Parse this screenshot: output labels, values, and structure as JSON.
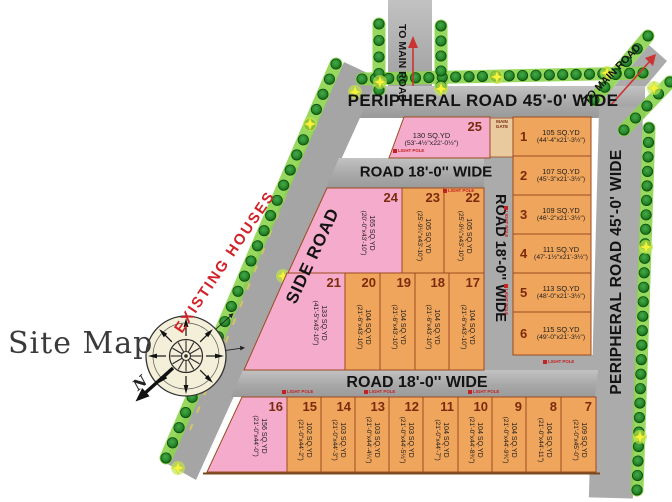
{
  "title": "Site Map",
  "annotations": {
    "existing_houses": "EXISTING HOUSES",
    "north": "N"
  },
  "roads": {
    "peripheral_top": "PERIPHERAL ROAD 45'-0' WIDE",
    "peripheral_right": "PERIPHERAL ROAD 45'-0' WIDE",
    "side": "SIDE ROAD",
    "inner_top": "ROAD 18'-0'' WIDE",
    "inner_vertical": "ROAD 18'-0'' WIDE",
    "inner_bottom": "ROAD 18'-0'' WIDE",
    "to_main_left": "TO MAIN ROAD",
    "to_main_right": "TO MAIN ROAD",
    "main_gate": "MAIN GATE",
    "light_pole": "LIGHT POLE"
  },
  "colors": {
    "plot_orange": "#F0A55C",
    "plot_pink": "#F5ABCB",
    "plot_border": "#9C4A1F",
    "road_gray": "#AFAFAF",
    "strip_green": "#8CD44E",
    "tree_dark": "#166916",
    "tree_mid": "#2E9232",
    "star_yellow": "#F4F43C",
    "number_brown": "#7A2B0C",
    "accent_red": "#D2232A"
  },
  "plots": [
    {
      "num": "1",
      "area": "105 SQ.YD",
      "dims": "(44'-4\"x21'-3½\")",
      "color": "orange"
    },
    {
      "num": "2",
      "area": "107 SQ.YD",
      "dims": "(45'-3\"x21'-3½\")",
      "color": "orange"
    },
    {
      "num": "3",
      "area": "109 SQ.YD",
      "dims": "(46'-2\"x21'-3½\")",
      "color": "orange"
    },
    {
      "num": "4",
      "area": "111 SQ.YD",
      "dims": "(47'-1½\"x21'-3½\")",
      "color": "orange"
    },
    {
      "num": "5",
      "area": "113 SQ.YD",
      "dims": "(48'-0\"x21'-3½\")",
      "color": "orange"
    },
    {
      "num": "6",
      "area": "115 SQ.YD",
      "dims": "(49'-0\"x21'-3½\")",
      "color": "orange"
    },
    {
      "num": "7",
      "area": "109 SQ.YD",
      "dims": "(21'-0\"x45'-0\")",
      "color": "orange"
    },
    {
      "num": "8",
      "area": "104 SQ.YD",
      "dims": "(21'-0\"x44'-11\")",
      "color": "orange"
    },
    {
      "num": "9",
      "area": "104 SQ.YD",
      "dims": "(21'-0\"x44'-9¾\")",
      "color": "orange"
    },
    {
      "num": "10",
      "area": "104 SQ.YD",
      "dims": "(21'-0\"x44'-8¾\")",
      "color": "orange"
    },
    {
      "num": "11",
      "area": "104 SQ.YD",
      "dims": "(21'-0\"x44'-7\")",
      "color": "orange"
    },
    {
      "num": "12",
      "area": "103 SQ.YD",
      "dims": "(21'-0\"x44'-5½\")",
      "color": "orange"
    },
    {
      "num": "13",
      "area": "103 SQ.YD",
      "dims": "(21'-0\"x44'-4¼\")",
      "color": "orange"
    },
    {
      "num": "14",
      "area": "103 SQ.YD",
      "dims": "(21'-0\"x44'-3\")",
      "color": "orange"
    },
    {
      "num": "15",
      "area": "102 SQ.YD",
      "dims": "(21'-0\"x44'-2\")",
      "color": "orange"
    },
    {
      "num": "16",
      "area": "156 SQ.YD",
      "dims": "(21'-0\"x44'-0\")",
      "color": "pink"
    },
    {
      "num": "17",
      "area": "104 SQ.YD",
      "dims": "(21'-6\"x43'-10\")",
      "color": "orange"
    },
    {
      "num": "18",
      "area": "104 SQ.YD",
      "dims": "(21'-6\"x43'-10\")",
      "color": "orange"
    },
    {
      "num": "19",
      "area": "104 SQ.YD",
      "dims": "(21'-6\"x43'-10\")",
      "color": "orange"
    },
    {
      "num": "20",
      "area": "104 SQ.YD",
      "dims": "(21'-6\"x43'-10\")",
      "color": "orange"
    },
    {
      "num": "21",
      "area": "133 SQ.YD",
      "dims": "(41'-5\"x43'-10\")",
      "color": "pink"
    },
    {
      "num": "22",
      "area": "105 SQ.YD",
      "dims": "(25'-9¼\"x43'-10\")",
      "color": "orange"
    },
    {
      "num": "23",
      "area": "105 SQ.YD",
      "dims": "(25'-9¼\"x43'-10\")",
      "color": "orange"
    },
    {
      "num": "24",
      "area": "165 SQ.YD",
      "dims": "(20'-0\"x43'-10\")",
      "color": "pink"
    },
    {
      "num": "25",
      "area": "130 SQ.YD",
      "dims": "(53'-4½\"x22'-0½\")",
      "color": "pink"
    }
  ]
}
